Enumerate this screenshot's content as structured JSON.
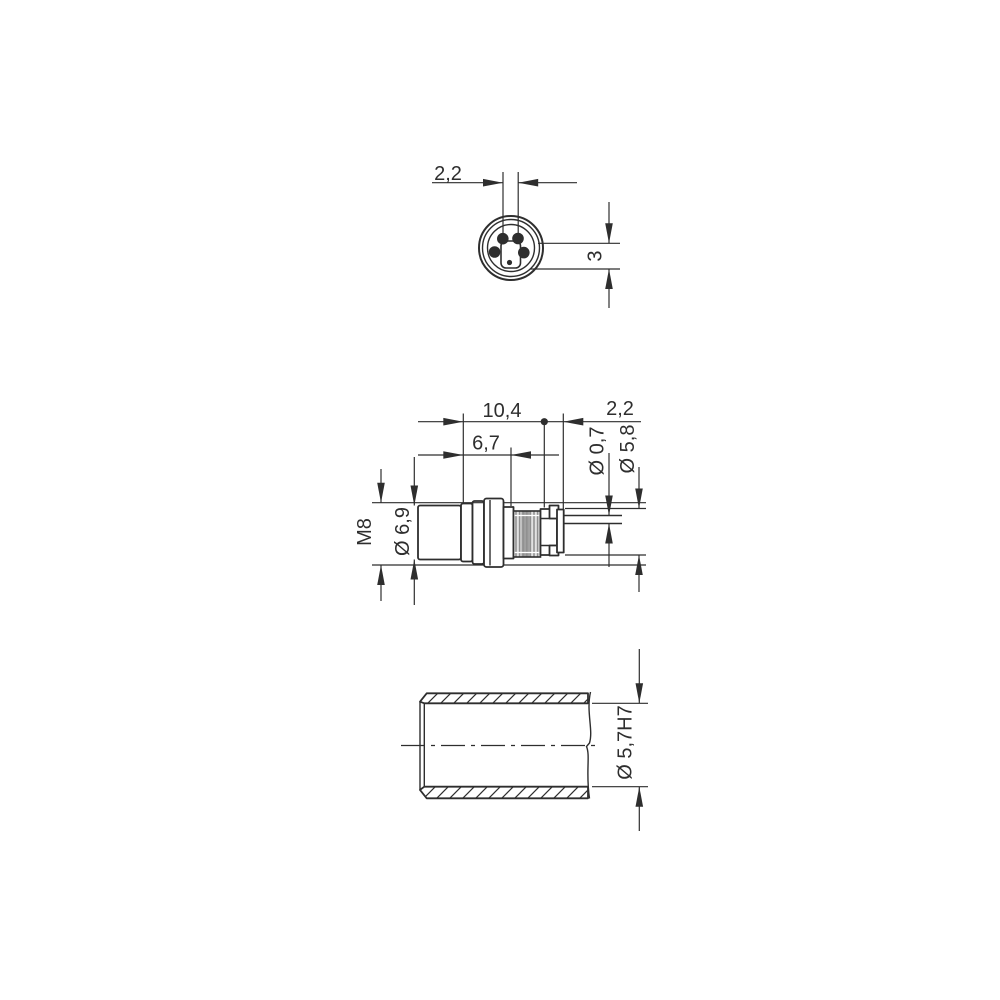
{
  "drawing": {
    "background_color": "#ffffff",
    "line_color": "#2e2e2e",
    "knurl_gray": "#a0a0a0",
    "front_view": {
      "pin_spacing": "2,2",
      "key_offset": "3"
    },
    "side_view": {
      "overall_length": "10,4",
      "tip_length": "2,2",
      "body_length": "6,7",
      "pin_diameter": "Ø 0,7",
      "tip_diameter": "Ø 5,8",
      "thread_size": "M8",
      "body_diameter": "Ø 6,9"
    },
    "section_view": {
      "bore_diameter": "Ø 5,7H7"
    }
  }
}
